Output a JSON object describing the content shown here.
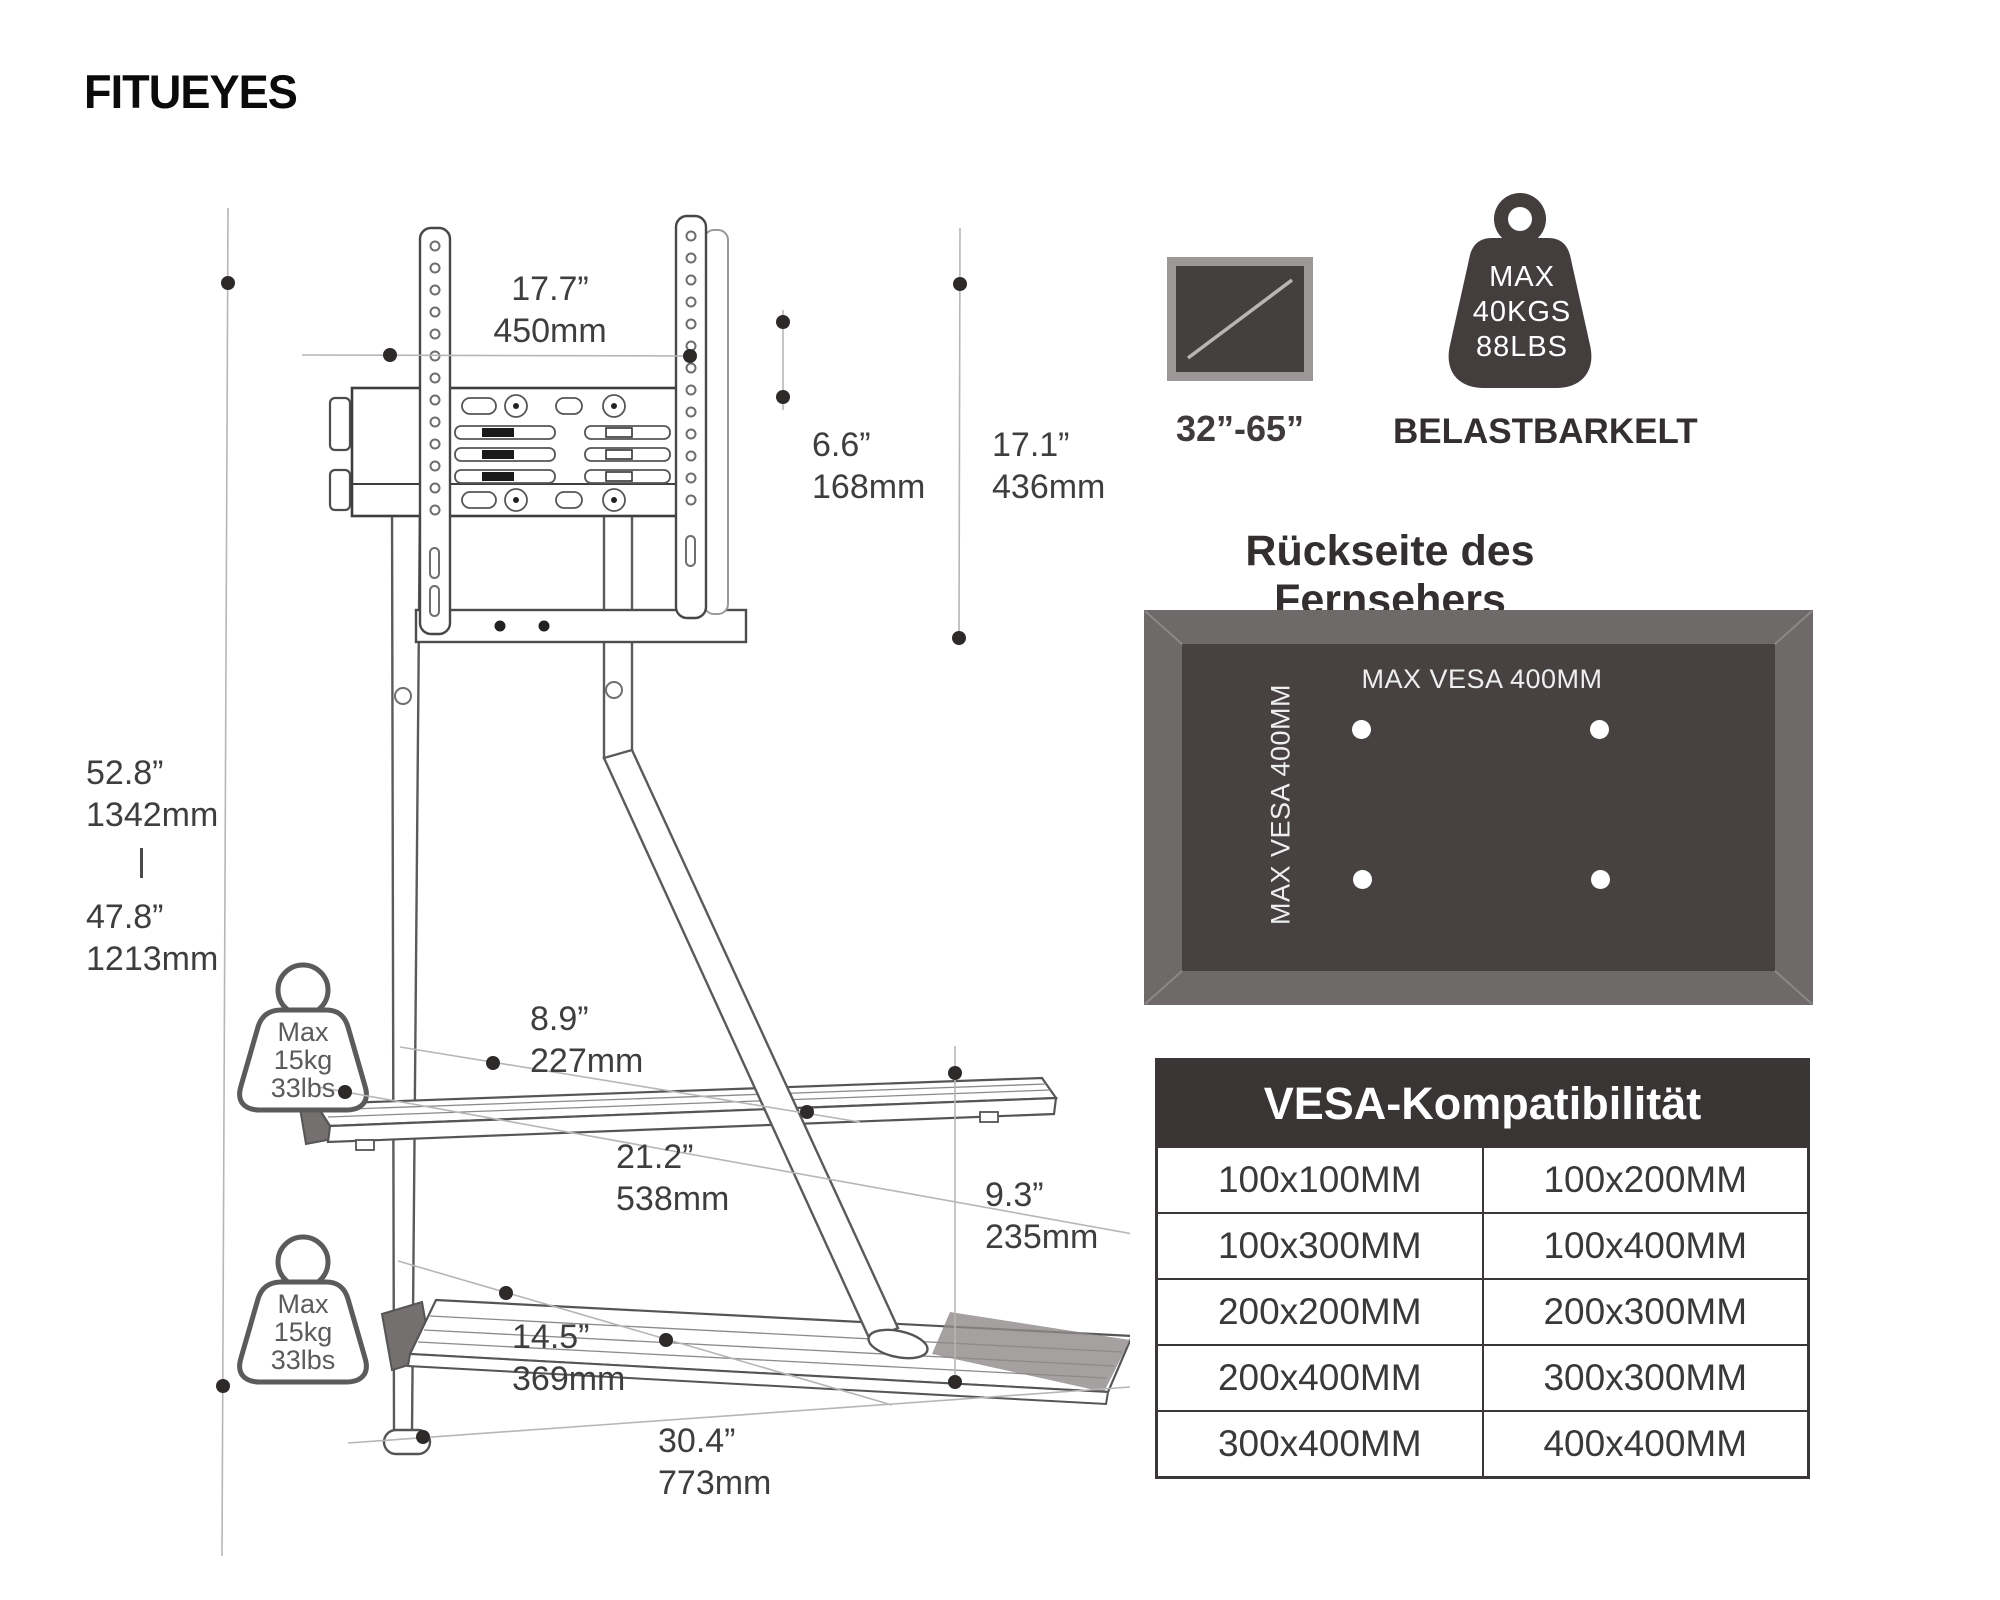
{
  "brand": {
    "name_light": "FITU",
    "name_bold": "EYES"
  },
  "diagram": {
    "dims": {
      "bracket_width": {
        "in": "17.7”",
        "mm": "450mm"
      },
      "bracket_depth": {
        "in": "6.6”",
        "mm": "168mm"
      },
      "bracket_height": {
        "in": "17.1”",
        "mm": "436mm"
      },
      "height_max": {
        "in": "52.8”",
        "mm": "1342mm"
      },
      "height_min": {
        "in": "47.8”",
        "mm": "1213mm"
      },
      "shelf_depth": {
        "in": "8.9”",
        "mm": "227mm"
      },
      "shelf_width": {
        "in": "21.2”",
        "mm": "538mm"
      },
      "base_clearance": {
        "in": "9.3”",
        "mm": "235mm"
      },
      "base_depth": {
        "in": "14.5”",
        "mm": "369mm"
      },
      "base_width": {
        "in": "30.4”",
        "mm": "773mm"
      }
    },
    "shelf_load": {
      "l1": "Max",
      "l2": "15kg",
      "l3": "33lbs"
    }
  },
  "panels": {
    "tv_size_label": "32”-65”",
    "capacity": {
      "l1": "MAX",
      "l2": "40KGS",
      "l3": "88LBS",
      "caption": "BELASTBARKELT"
    },
    "back": {
      "title": "Rückseite des Fernsehers",
      "vesa_horizontal": "MAX VESA 400MM",
      "vesa_vertical": "MAX VESA 400MM"
    },
    "vesa": {
      "title": "VESA-Kompatibilität",
      "rows": [
        [
          "100x100MM",
          "100x200MM"
        ],
        [
          "100x300MM",
          "100x400MM"
        ],
        [
          "200x200MM",
          "200x300MM"
        ],
        [
          "200x400MM",
          "300x300MM"
        ],
        [
          "300x400MM",
          "400x400MM"
        ]
      ]
    }
  },
  "colors": {
    "ink": "#3d3b3b",
    "line_art": "#555555",
    "dim_line": "#b8b5b5",
    "dim_dot": "#2e2a2a",
    "panel_outer": "#6f6a6a",
    "panel_inner": "#474141",
    "table_header_bg": "#3a3535",
    "tv_icon_border": "#9c9898",
    "tv_icon_screen": "#454040"
  }
}
